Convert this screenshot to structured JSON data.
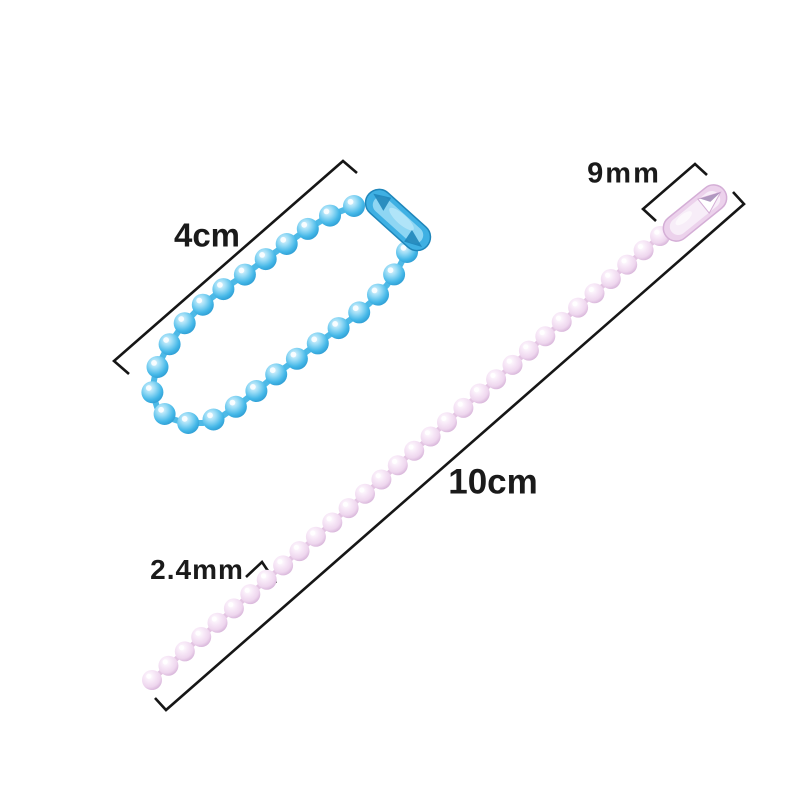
{
  "annotations": {
    "blue_chain_length": "4cm",
    "pink_connector_length": "9mm",
    "pink_chain_length": "10cm",
    "pink_bead_diameter": "2.4mm"
  },
  "colors": {
    "background": "#ffffff",
    "dimension_line": "#161616",
    "label_text": "#1a1a1a",
    "blue_bead": "#45b8e8",
    "blue_bead_dark": "#2694cc",
    "blue_bead_light": "#9adcf6",
    "blue_link": "#4db9e6",
    "blue_connector": "#3fb0e3",
    "blue_connector_edge": "#1f86ba",
    "blue_connector_inner": "#8ed6f3",
    "pink_bead": "#eed6ee",
    "pink_bead_dark": "#cfa9d2",
    "pink_bead_light": "#f8eaf8",
    "pink_link": "#e3c4e2",
    "pink_connector": "#ecd2ec",
    "pink_connector_edge": "#d4aed6",
    "pink_connector_inner": "#f7edf8",
    "pink_connector_notch_shadow": "#a287b5"
  }
}
